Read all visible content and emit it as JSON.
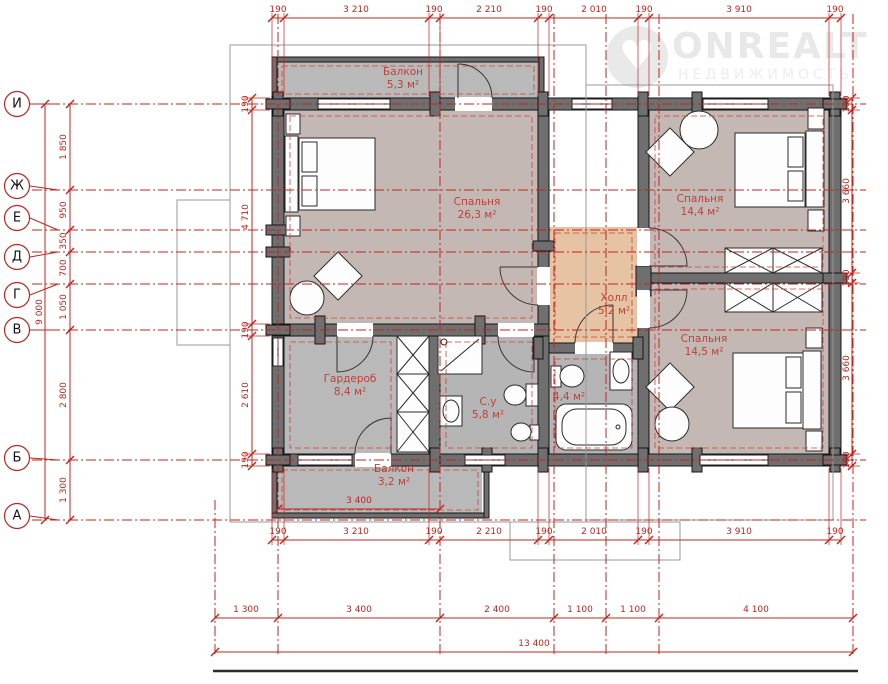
{
  "watermark": {
    "brand": "ONREALT",
    "subtitle": "НЕДВИЖИМОСТЬ"
  },
  "axes": {
    "labels": [
      "И",
      "Ж",
      "Е",
      "Д",
      "Г",
      "В",
      "Б",
      "А"
    ]
  },
  "rooms": {
    "balcony_top": {
      "name": "Балкон",
      "area": "5,3 м²"
    },
    "bedroom_main": {
      "name": "Спальня",
      "area": "26,3 м²"
    },
    "bedroom_right_top": {
      "name": "Спальня",
      "area": "14,4 м²"
    },
    "hall": {
      "name": "Холл",
      "area": "5,2 м²"
    },
    "bedroom_right_bottom": {
      "name": "Спальня",
      "area": "14,5 м²"
    },
    "wardrobe": {
      "name": "Гардероб",
      "area": "8,4 м²"
    },
    "bathroom": {
      "name": "С.у",
      "area": "5,8 м²"
    },
    "bathroom_small": {
      "area": "4,4 м²"
    },
    "balcony_bottom": {
      "name": "Балкон",
      "area": "3,2 м²"
    }
  },
  "dims": {
    "top": [
      "190",
      "3 210",
      "190",
      "2 210",
      "190",
      "2 010",
      "190",
      "3 910",
      "190"
    ],
    "inner_bottom": [
      "190",
      "3 210",
      "190",
      "2 210",
      "190",
      "2 010",
      "190",
      "3 910",
      "190"
    ],
    "bottom_spans": [
      "1 300",
      "3 400",
      "2 400",
      "1 100",
      "1 100",
      "4 100"
    ],
    "bottom_total": "13 400",
    "balcony_width": "3 400",
    "left_total": "9 000",
    "left_spans": [
      "1 850",
      "950",
      "350",
      "700",
      "1 050",
      "2 800",
      "1 300"
    ],
    "left_inner": [
      "190",
      "4 710",
      "190",
      "2 610",
      "190"
    ],
    "right_spans": [
      "190",
      "3 660",
      "190",
      "3 660",
      "190"
    ]
  },
  "colors": {
    "dimension_red": "#c0251e",
    "wall_gray": "#6f6f6f",
    "room_mauve": "#c4b8b5",
    "service_gray": "#b9b9b9",
    "hall_tan": "#e6c3a3"
  }
}
